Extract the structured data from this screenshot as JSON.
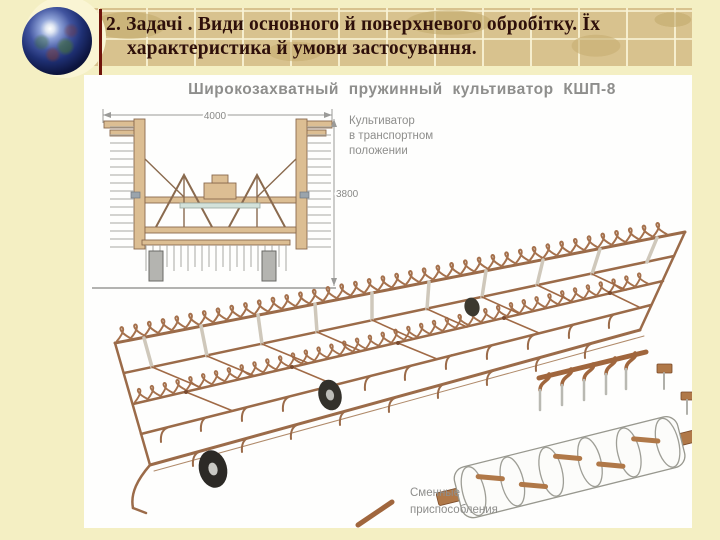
{
  "slide": {
    "title_line1": "2. Задачі . Види основного й поверхневого обробітку. Їх",
    "title_line2": "характеристика й умови застосування."
  },
  "figure": {
    "heading": "Широкозахватный  пружинный  культиватор  КШП-8",
    "front_view": {
      "width_mm": "4000",
      "height_mm": "3800",
      "caption": [
        "Культиватор",
        "в транспортном",
        "положении"
      ]
    },
    "attachments_caption": [
      "Сменные",
      "приспособления"
    ]
  },
  "icons": {
    "globe": "earth-globe"
  },
  "colors": {
    "background": "#F4EFC3",
    "title_band": "#D8C28E",
    "band_grid": "#F9F3D5",
    "accent_red": "#70140B",
    "title_text": "#2E0F0A",
    "panel": "#FEFEFD",
    "label_gray": "#8E8E8C",
    "drawing_brown": "#9B6B49",
    "drawing_tan": "#DCBE93",
    "wheel_dark": "#2C2A26"
  }
}
